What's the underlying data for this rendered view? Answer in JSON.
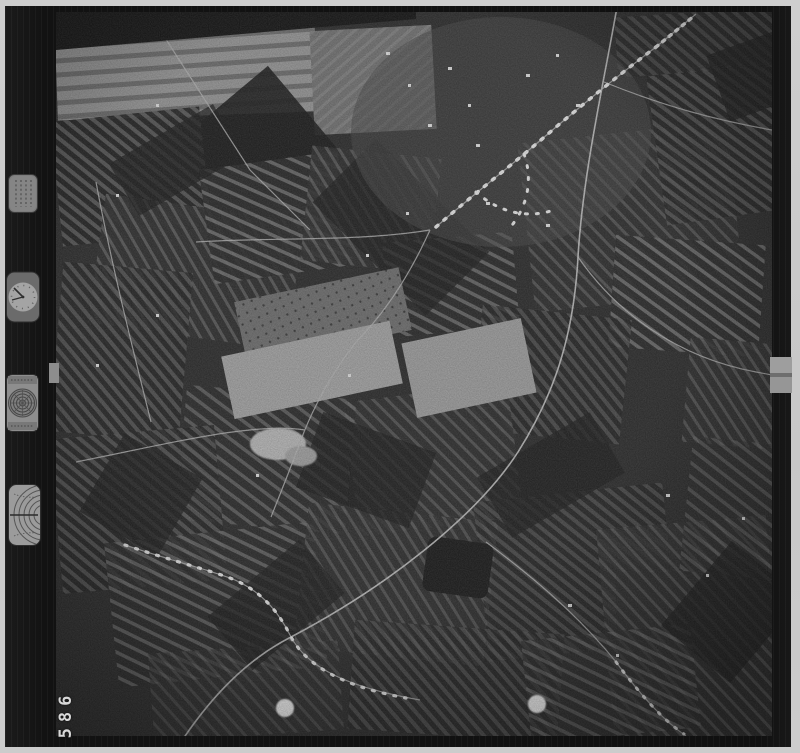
{
  "scan": {
    "frame_number": "586",
    "content_type": "black-and-white aerial photograph of striped farmland, villages and a curving railway",
    "marker_dot_count": 2
  },
  "film_strip": {
    "instruments": [
      {
        "name": "info-plate-icon"
      },
      {
        "name": "clock-dial-icon"
      },
      {
        "name": "target-level-dial-icon"
      },
      {
        "name": "altitude-arc-gauge-icon"
      }
    ]
  },
  "colors": {
    "scanner_bed": "#c9c9c9",
    "film_frame": "#131313",
    "terrain_dark": "#2e2e2e",
    "terrain_light": "#9e9e9e",
    "road": "#c4c4c4",
    "marker_dot": "#f2f2f2",
    "frame_number_color": "#d8d8d8"
  }
}
